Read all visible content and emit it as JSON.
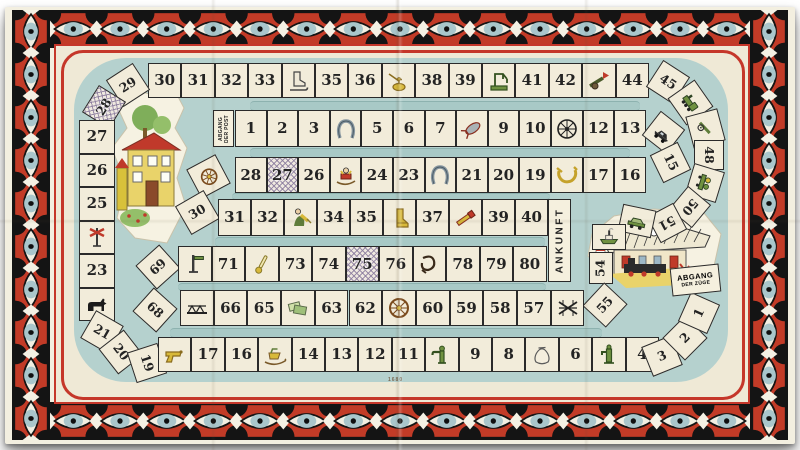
{
  "game": {
    "labels": {
      "post_start": [
        "ABGANG",
        "DER POST"
      ],
      "train_start": [
        "ABGANG",
        "DER ZÜGE"
      ],
      "finish": "ANKUNFT",
      "plate_number": "1680"
    },
    "colors": {
      "band_red": "#c23b27",
      "frame_red": "#c5372a",
      "track_teal": "#b5d1ce",
      "square_cream": "#f2ecda",
      "line_black": "#1f1f1f",
      "eye_iris_blue": "#a9c6cb",
      "hatch_lilac": "#8b7c9e"
    },
    "post_track": {
      "name": "post-track",
      "cells": [
        {
          "n": "1"
        },
        {
          "n": "2"
        },
        {
          "n": "3"
        },
        {
          "icon": "horseshoe-icon"
        },
        {
          "n": "5"
        },
        {
          "n": "6"
        },
        {
          "n": "7"
        },
        {
          "icon": "crayfish-icon"
        },
        {
          "n": "9"
        },
        {
          "n": "10"
        },
        {
          "icon": "wagon-wheel-icon"
        },
        {
          "n": "12"
        },
        {
          "n": "13"
        },
        {
          "icon": "motorcar-icon"
        },
        {
          "n": "15"
        },
        {
          "n": "16"
        },
        {
          "n": "17"
        },
        {
          "icon": "post-horn-icon"
        },
        {
          "n": "19"
        },
        {
          "n": "20"
        },
        {
          "n": "21"
        },
        {
          "icon": "horseshoe-icon"
        },
        {
          "n": "23"
        },
        {
          "n": "24"
        },
        {
          "icon": "sled-icon"
        },
        {
          "n": "26"
        },
        {
          "n": "27",
          "hatched": true
        },
        {
          "n": "28"
        },
        {
          "icon": "coach-wheel-icon"
        },
        {
          "n": "30"
        },
        {
          "n": "31"
        },
        {
          "n": "32"
        },
        {
          "icon": "harvest-woman-icon"
        },
        {
          "n": "34"
        },
        {
          "n": "35"
        },
        {
          "icon": "boot-icon"
        },
        {
          "n": "37"
        },
        {
          "icon": "spyglass-icon"
        },
        {
          "n": "39"
        },
        {
          "n": "40"
        }
      ]
    },
    "train_track": {
      "name": "train-track",
      "cells": [
        {
          "n": "1"
        },
        {
          "n": "2"
        },
        {
          "n": "3"
        },
        {
          "n": "4"
        },
        {
          "icon": "water-pump-icon"
        },
        {
          "n": "6"
        },
        {
          "icon": "sack-icon"
        },
        {
          "n": "8"
        },
        {
          "n": "9"
        },
        {
          "icon": "water-crane-icon"
        },
        {
          "n": "11"
        },
        {
          "n": "12"
        },
        {
          "n": "13"
        },
        {
          "n": "14"
        },
        {
          "icon": "sleigh-icon"
        },
        {
          "n": "16"
        },
        {
          "n": "17"
        },
        {
          "icon": "pistol-icon"
        },
        {
          "n": "19"
        },
        {
          "n": "20"
        },
        {
          "n": "21"
        },
        {
          "icon": "dog-icon"
        },
        {
          "n": "23"
        },
        {
          "icon": "crossing-sign-icon"
        },
        {
          "n": "25"
        },
        {
          "n": "26"
        },
        {
          "n": "27"
        },
        {
          "n": "28",
          "hatched": true
        },
        {
          "n": "29"
        },
        {
          "n": "30"
        },
        {
          "n": "31"
        },
        {
          "n": "32"
        },
        {
          "n": "33"
        },
        {
          "icon": "ice-skate-icon"
        },
        {
          "n": "35"
        },
        {
          "n": "36"
        },
        {
          "icon": "oil-can-icon"
        },
        {
          "n": "38"
        },
        {
          "n": "39"
        },
        {
          "icon": "crane-icon"
        },
        {
          "n": "41"
        },
        {
          "n": "42"
        },
        {
          "icon": "cannon-icon"
        },
        {
          "n": "44"
        },
        {
          "n": "45"
        },
        {
          "icon": "locomotive-icon"
        },
        {
          "icon": "field-gun-icon"
        },
        {
          "n": "48"
        },
        {
          "icon": "handcar-icon"
        },
        {
          "n": "50"
        },
        {
          "n": "51"
        },
        {
          "icon": "motorcar-green-icon"
        },
        {
          "icon": "steamboat-icon"
        },
        {
          "n": "54"
        },
        {
          "n": "55"
        },
        {
          "icon": "rail-switch-icon"
        },
        {
          "n": "57"
        },
        {
          "n": "58"
        },
        {
          "n": "59"
        },
        {
          "n": "60"
        },
        {
          "icon": "coach-wheel-icon"
        },
        {
          "n": "62"
        },
        {
          "n": "63"
        },
        {
          "icon": "banknotes-icon"
        },
        {
          "n": "65"
        },
        {
          "n": "66"
        },
        {
          "icon": "bridge-icon"
        },
        {
          "n": "68"
        },
        {
          "n": "69"
        },
        {
          "icon": "semaphore-icon"
        },
        {
          "n": "71"
        },
        {
          "icon": "thermometer-icon"
        },
        {
          "n": "73"
        },
        {
          "n": "74"
        },
        {
          "n": "75",
          "hatched": true
        },
        {
          "n": "76"
        },
        {
          "icon": "satchel-icon"
        },
        {
          "n": "78"
        },
        {
          "n": "79"
        },
        {
          "n": "80"
        }
      ]
    }
  }
}
